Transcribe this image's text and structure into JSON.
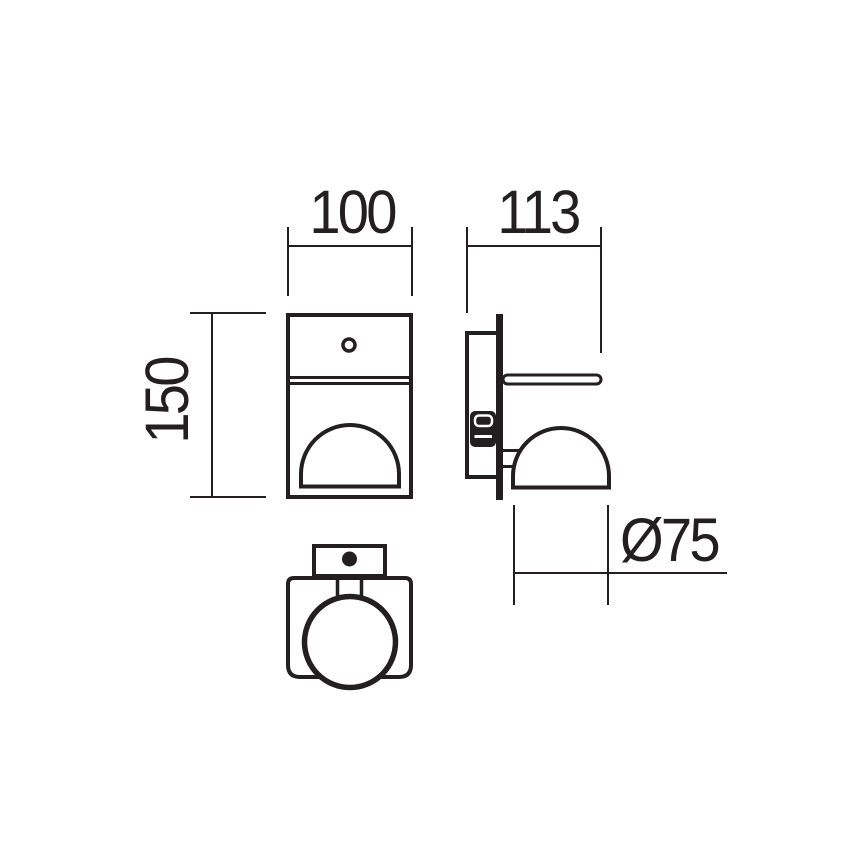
{
  "canvas": {
    "width": 868,
    "height": 868,
    "background": "#ffffff",
    "line_color": "#231f20"
  },
  "drawing": {
    "type": "technical-dimension-drawing",
    "subject": "wall-light-fixture",
    "dimensions": {
      "width": {
        "label": "100"
      },
      "depth": {
        "label": "113"
      },
      "height": {
        "label": "150"
      },
      "diameter": {
        "label": "Ø75"
      }
    }
  }
}
